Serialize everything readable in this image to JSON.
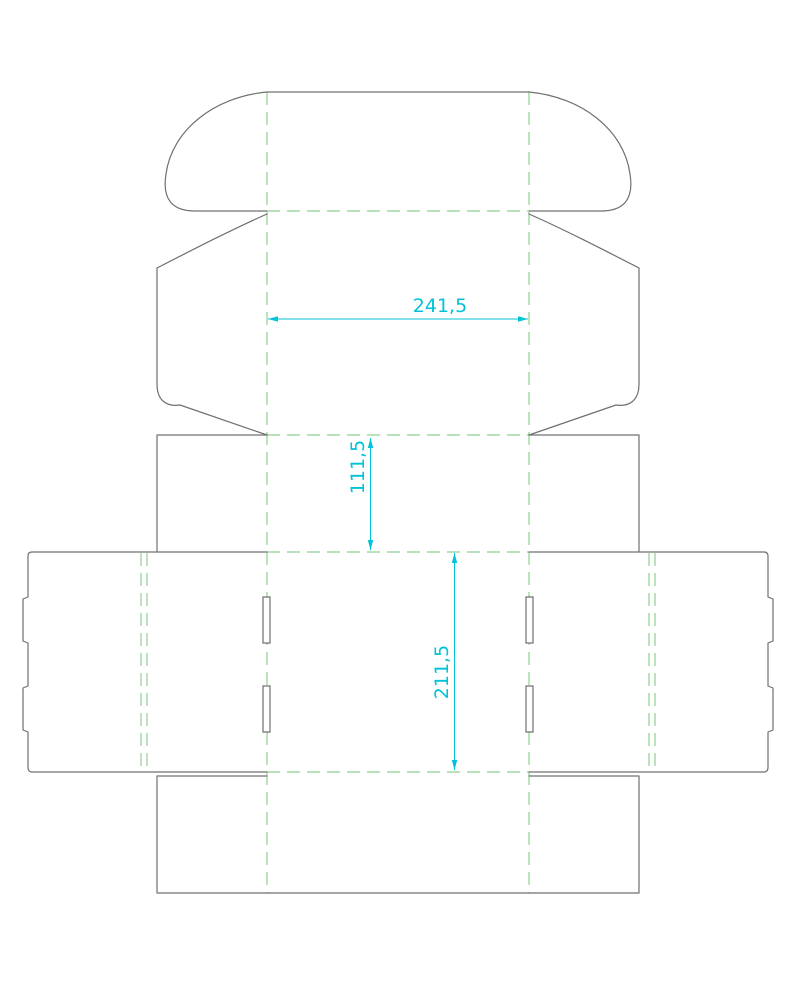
{
  "colors": {
    "background": "#ffffff",
    "cut_line": "#707070",
    "fold_line": "#90d090",
    "dimension": "#00c3d7"
  },
  "dieline": {
    "dimensions": {
      "width": {
        "label": "241,5"
      },
      "depth": {
        "label": "111,5"
      },
      "length": {
        "label": "211,5"
      }
    }
  }
}
